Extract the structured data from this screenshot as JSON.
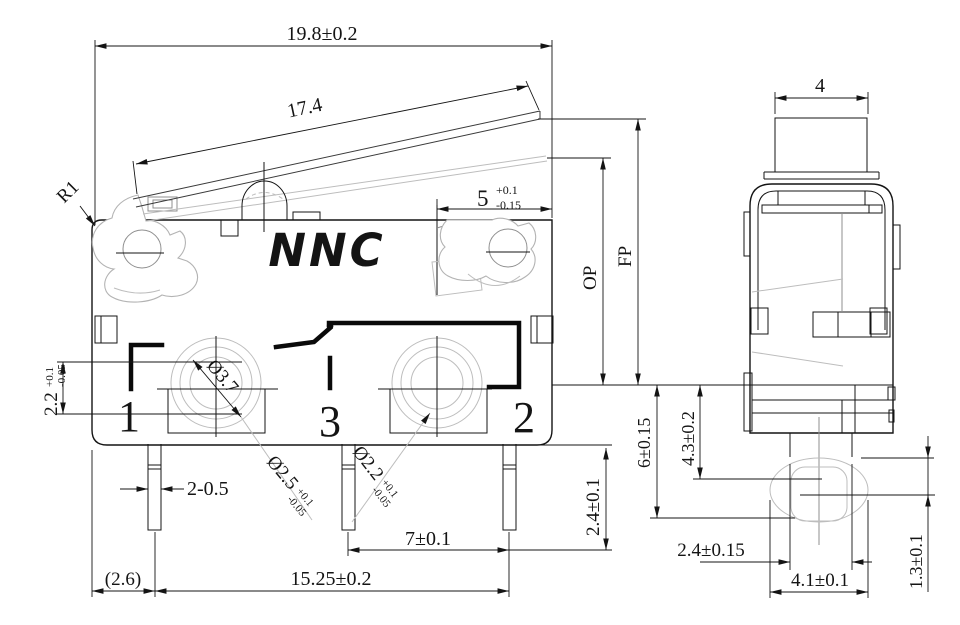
{
  "drawing": {
    "logo": "NNC",
    "terminals": {
      "one": "1",
      "three": "3",
      "two": "2"
    },
    "front": {
      "dim_width_top": "19.8±0.2",
      "dim_lever": "17.4",
      "radius_label": "R1",
      "dim_lever_free": {
        "base": "5",
        "plus": "+0.1",
        "minus": "-0.15"
      },
      "op_label": "OP",
      "fp_label": "FP",
      "dim_contact": {
        "base": "2.2",
        "plus": "+0.1",
        "minus": "-0.05"
      },
      "dia_hole": "Ø3.7",
      "dia_pin1": {
        "base": "Ø2.5",
        "plus": "+0.1",
        "minus": "-0.05"
      },
      "dia_pin2": {
        "base": "Ø2.2",
        "plus": "+0.1",
        "minus": "-0.05"
      },
      "dim_pin_width": "2-0.5",
      "dim_pitch": "7±0.1",
      "dim_span": "15.25±0.2",
      "dim_offset": "(2.6)",
      "dim_pin_length": "2.4±0.1"
    },
    "side": {
      "dim_button_width": "4",
      "dim_total_height": "6±0.15",
      "dim_body_height": "4.3±0.2",
      "dim_neck": "2.4±0.15",
      "dim_boss": "4.1±0.1",
      "dim_tip": "1.3±0.1"
    },
    "colors": {
      "line": "#141414",
      "light": "#bdbdbd",
      "background": "#ffffff"
    }
  }
}
